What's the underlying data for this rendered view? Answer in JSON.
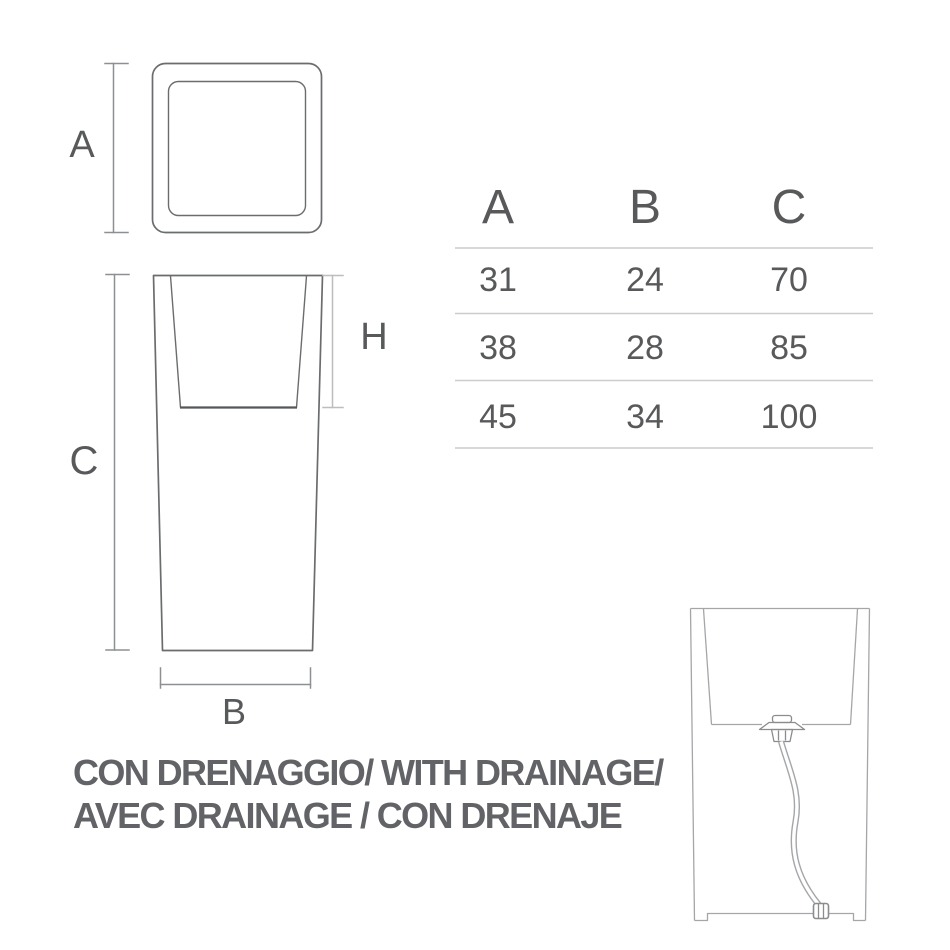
{
  "labels": {
    "a": "A",
    "b": "B",
    "c": "C",
    "h": "H"
  },
  "table": {
    "headers": [
      "A",
      "B",
      "C"
    ],
    "rows": [
      [
        "31",
        "24",
        "70"
      ],
      [
        "38",
        "28",
        "85"
      ],
      [
        "45",
        "34",
        "100"
      ]
    ]
  },
  "caption": {
    "line1": "CON DRENAGGIO/ WITH DRAINAGE/",
    "line2": "AVEC DRAINAGE / CON DRENAJE"
  },
  "colors": {
    "line_dark": "#6a6c6e",
    "line_darker": "#56575a",
    "dim": "#8d8f92",
    "dim_light": "#bbbdbf",
    "line_light": "#a4a6a9",
    "valve": "#8a8c8f",
    "table_rule": "#cbcccd",
    "text": "#58595b",
    "caption": "#626366"
  }
}
